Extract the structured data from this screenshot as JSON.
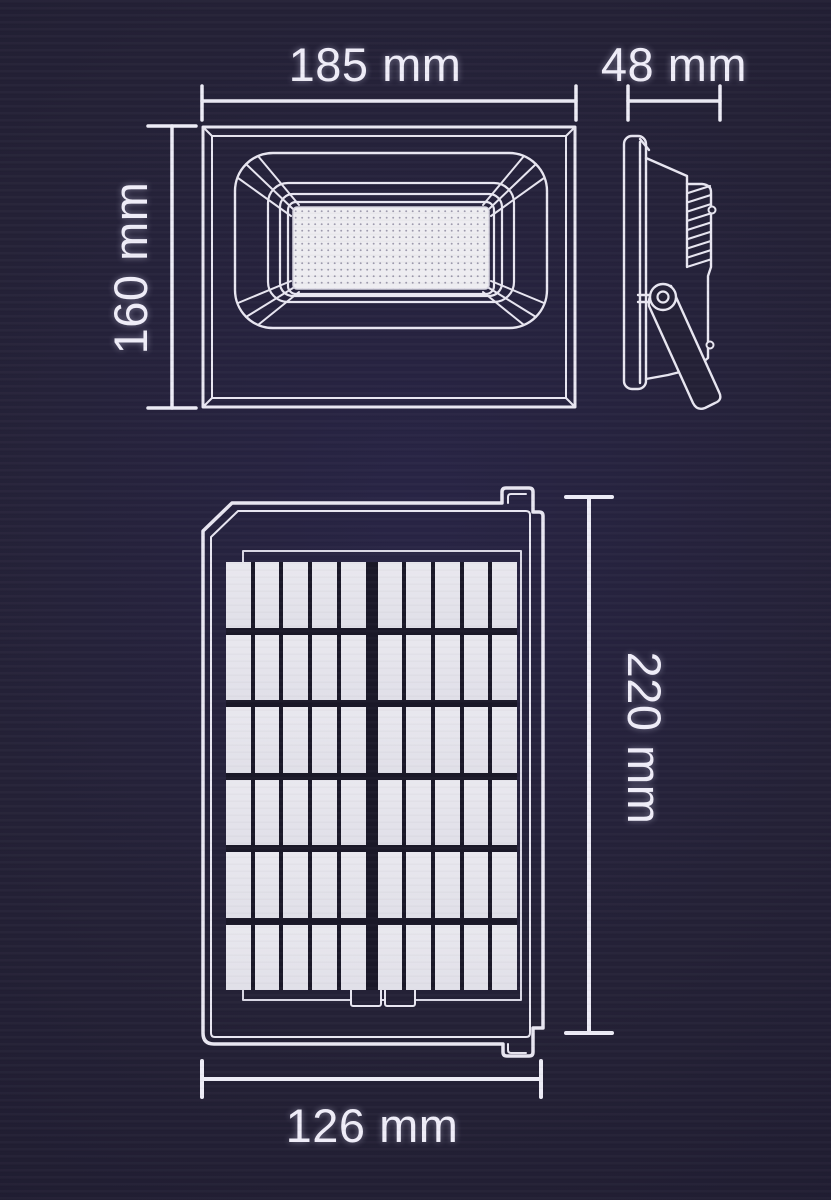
{
  "page": {
    "type": "technical dimension diagram",
    "unit": "mm"
  },
  "colors": {
    "background": "#242136",
    "line": "#e8e6f1",
    "dimension_line": "#edecf6",
    "text": "#efedf8",
    "solar_cell": "#e4e3eb",
    "led_panel": "#eeedf1"
  },
  "views": {
    "front": {
      "name": "floodlight front view",
      "width": {
        "value": 185,
        "label": "185 mm"
      },
      "height": {
        "value": 160,
        "label": "160 mm"
      }
    },
    "side": {
      "name": "floodlight side view",
      "depth": {
        "value": 48,
        "label": "48 mm"
      }
    },
    "solar_panel": {
      "name": "solar panel front view",
      "height": {
        "value": 220,
        "label": "220 mm"
      },
      "width": {
        "value": 126,
        "label": "126 mm"
      },
      "cell_rows": 6,
      "cell_columns": 10
    }
  }
}
